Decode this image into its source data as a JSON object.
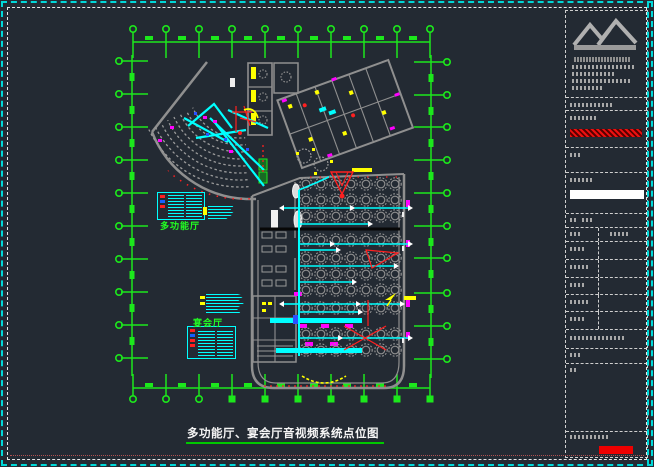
{
  "drawing": {
    "title": "多功能厅、宴会厅音视频系统点位图",
    "halls": {
      "multifunction": "多功能厅",
      "banquet": "宴会厅"
    }
  },
  "colors": {
    "background": "#232a33",
    "grid_green": "#1ce81c",
    "wall_gray": "#8f8f8f",
    "seat_gray": "#9a9a9a",
    "cable_cyan": "#00ffff",
    "accent_red": "#ff2020",
    "accent_yellow": "#ffff00",
    "accent_magenta": "#ff00ff",
    "accent_blue": "#2a50ff",
    "device_white": "#eeeeee",
    "border_cyan": "#00d8d8",
    "title_underline_green": "#00c800",
    "titleblock_red_bar": "#ee0000"
  },
  "icons": {
    "company_logo": "mountain-logo-icon",
    "grid_bubble": "grid-axis-bubble",
    "speaker_symbol": "red-triangle-speaker",
    "cable_arrow": "white-arrowhead"
  }
}
